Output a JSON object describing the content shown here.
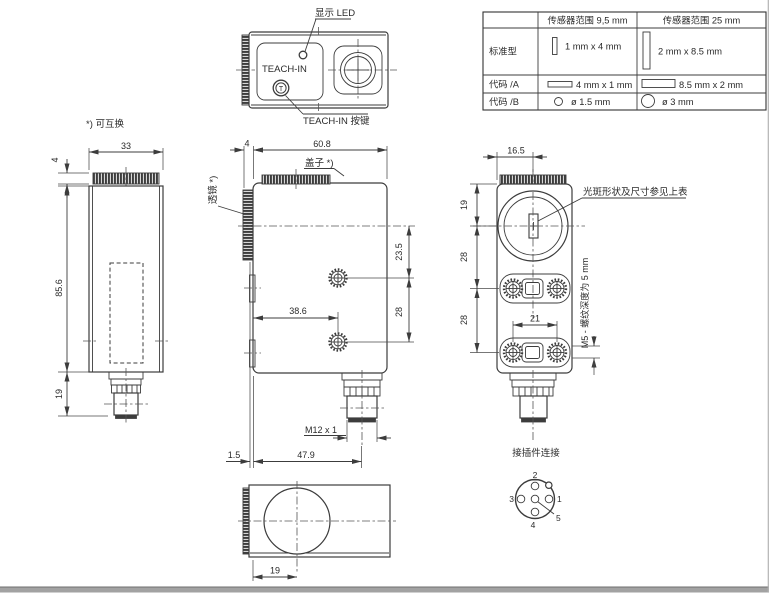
{
  "views": {
    "top": {
      "led_label": "显示 LED",
      "teach_label": "TEACH-IN",
      "button_glyph": "T",
      "button_label": "TEACH-IN 按键"
    },
    "side": {
      "note": "*) 可互换",
      "width": "33",
      "lens_protrusion": "4",
      "height": "85.6",
      "connector_height": "19"
    },
    "front": {
      "cover_label": "盖子 *)",
      "lens_label": "透镜 *)",
      "lens_width": "4",
      "width": "60.8",
      "hole1_offset": "23.5",
      "hole_spacing": "28",
      "hole2_offset": "38.6",
      "thread_label": "M12 x 1",
      "lens_face_offset": "1.5",
      "connector_offset": "47.9"
    },
    "optical": {
      "width": "16.5",
      "lens_center_offset": "19",
      "spacing_a": "28",
      "spacing_b": "28",
      "slot_hole_spacing": "21",
      "spot_note": "光斑形状及尺寸参见上表",
      "thread_note": "M5 - 螺纹深度为 5 mm"
    },
    "bottom": {
      "lens_center_offset": "19"
    },
    "pinout": {
      "title": "接插件连接",
      "pin1": "1",
      "pin2": "2",
      "pin3": "3",
      "pin4": "4",
      "pin5": "5"
    }
  },
  "spot_table": {
    "col_headers": [
      "传感器范围 9,5 mm",
      "传感器范围 25 mm"
    ],
    "rows": [
      {
        "label": "标准型",
        "range95": "1 mm x 4 mm",
        "range25": "2 mm x 8.5 mm"
      },
      {
        "label": "代码 /A",
        "range95": "4 mm x 1 mm",
        "range25": "8.5 mm x 2 mm"
      },
      {
        "label": "代码 /B",
        "range95": "ø 1.5 mm",
        "range25": "ø 3 mm"
      }
    ]
  },
  "colors": {
    "line": "#3c3c3c",
    "footer_bar": "#a2a2a2"
  }
}
